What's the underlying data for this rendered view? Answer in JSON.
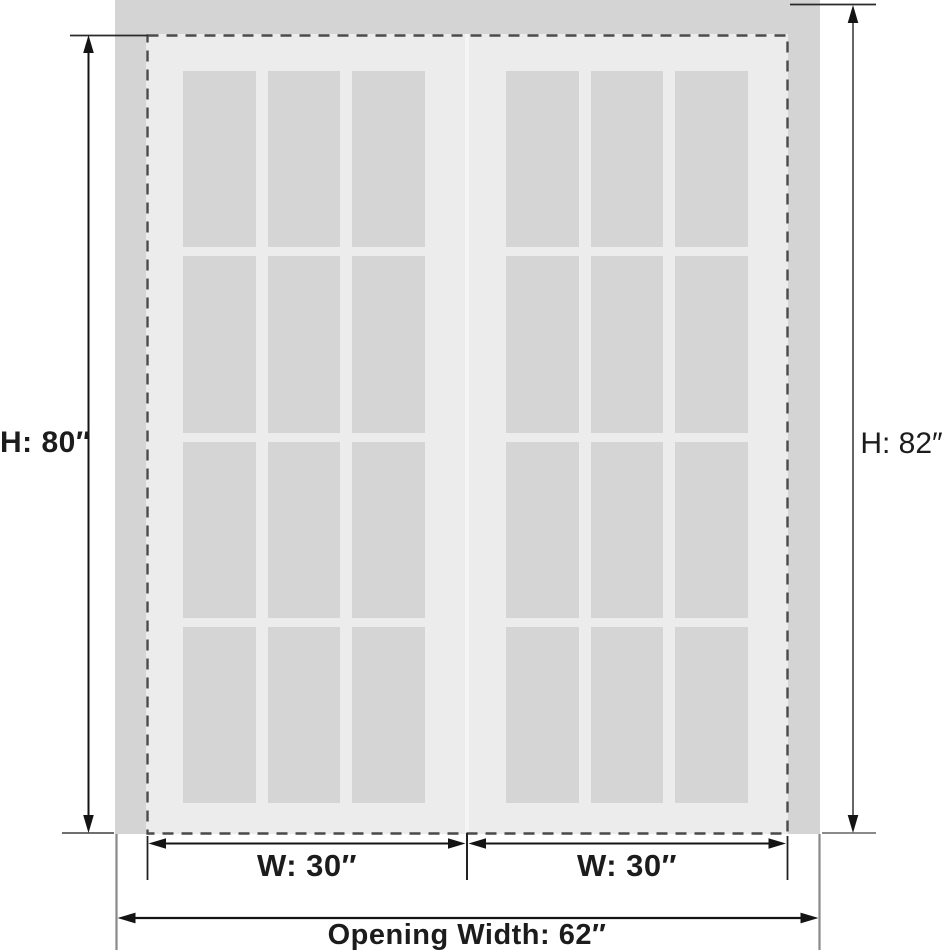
{
  "diagram": {
    "title": "double-door-dimension-diagram",
    "labels": {
      "height_left": "H: 80″",
      "height_right": "H: 82″",
      "width_left_door": "W: 30″",
      "width_right_door": "W: 30″",
      "opening_width": "Opening Width: 62″"
    },
    "doors": {
      "count": 2,
      "panes_per_door": {
        "columns": 3,
        "rows": 4
      }
    },
    "colors": {
      "background": "#ffffff",
      "wall": "#d4d4d4",
      "door_slab": "#ececec",
      "glass": "#d5d5d5",
      "seam": "#f5f5f5",
      "dim_line": "#141414",
      "dim_line_soft": "#666666",
      "ext_line": "#8a8a8a",
      "dashed_outline": "#4a4a4a",
      "label": "#1c1c1c"
    }
  }
}
